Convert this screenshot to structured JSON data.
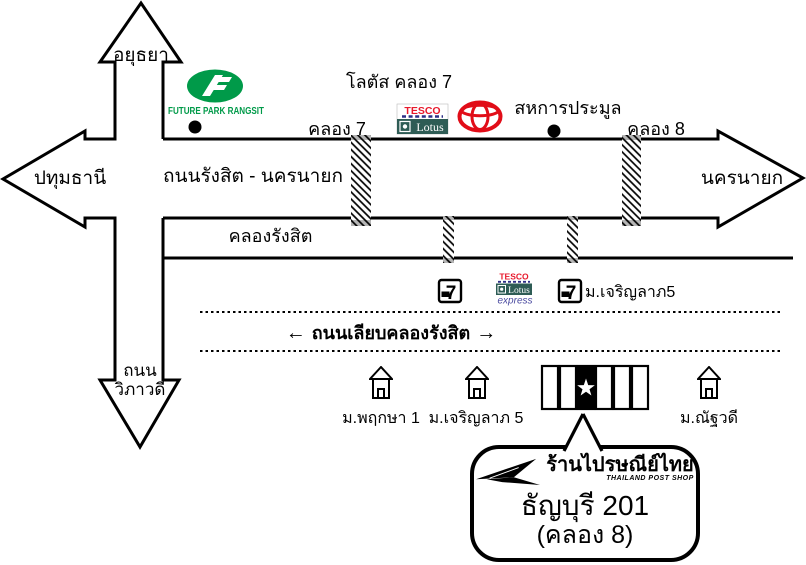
{
  "labels": {
    "north": "อยุธยา",
    "west": "ปทุมธานี",
    "south_line1": "ถนน",
    "south_line2": "วิภาวดี",
    "east": "นครนายก",
    "main_road": "ถนนรังสิต - นครนายก",
    "canal": "คลองรังสิต",
    "khlong7": "คลอง 7",
    "khlong8": "คลอง 8",
    "lotus_khlong7": "โลตัส คลอง 7",
    "sahakan": "สหการประมูล",
    "charoenlap5_north": "ม.เจริญลาภ5",
    "frontage_road": "ถนนเลียบคลองรังสิต",
    "frontage_arrow_left": "←",
    "frontage_arrow_right": "→",
    "phruksa1": "ม.พฤกษา 1",
    "charoenlap5_south": "ม.เจริญลาภ 5",
    "natthawadi": "ม.ณัฐวดี"
  },
  "logos": {
    "future_park": "FUTURE PARK RANGSIT",
    "tesco": "TESCO",
    "lotus": "Lotus",
    "express": "express",
    "seven": "7"
  },
  "callout": {
    "brand_thai": "ร้านไปรษณีย์ไทย",
    "brand_en": "THAILAND POST SHOP",
    "name": "ธัญบุรี 201",
    "detail": "(คลอง 8)"
  },
  "colors": {
    "line": "#000000",
    "future_park_green": "#009A49",
    "tesco_red": "#E8192C",
    "tesco_teal": "#2E5C55",
    "tesco_dash_blue": "#2D2F86",
    "express_blue": "#4B4BA0",
    "toyota_red": "#E10D18",
    "bridge_cap_gray": "#B5B5B5"
  }
}
